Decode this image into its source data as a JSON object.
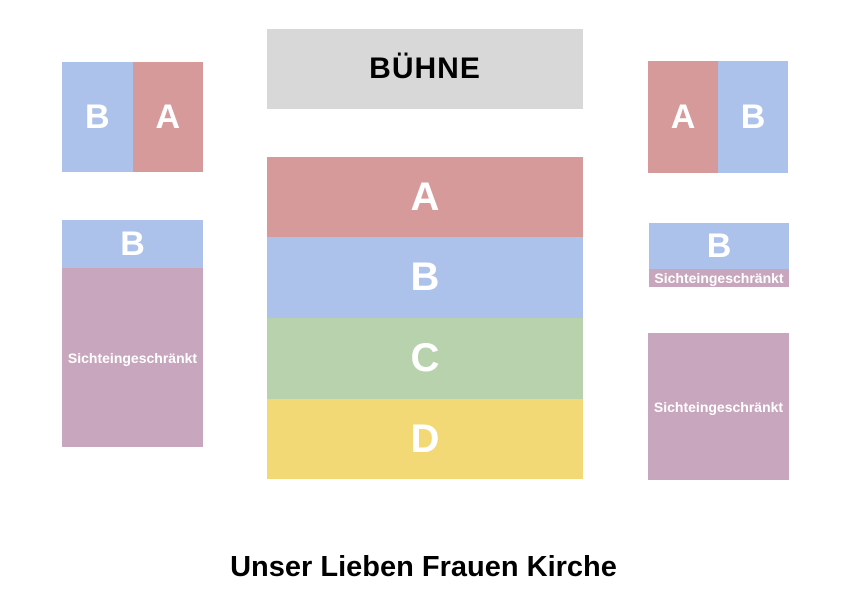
{
  "stage": {
    "label": "BÜHNE"
  },
  "venue_title": "Unser Lieben Frauen Kirche",
  "colors": {
    "category_a": "#d69a9a",
    "category_b": "#adc2eb",
    "category_c": "#b8d2ad",
    "category_d": "#f2d976",
    "restricted": "#c8a6bd",
    "stage": "#d8d8d8",
    "section_label_text": "#ffffff",
    "heading_text": "#000000"
  },
  "sections": {
    "left_front": {
      "left_label": "B",
      "right_label": "A"
    },
    "right_front": {
      "left_label": "A",
      "right_label": "B"
    },
    "center_rows": [
      {
        "label": "A"
      },
      {
        "label": "B"
      },
      {
        "label": "C"
      },
      {
        "label": "D"
      }
    ],
    "left_side": {
      "label": "B",
      "restricted_label": "Sichteingeschränkt"
    },
    "right_side": {
      "label": "B",
      "restricted_label": "Sichteingeschränkt"
    },
    "right_rear": {
      "restricted_label": "Sichteingeschränkt"
    }
  }
}
